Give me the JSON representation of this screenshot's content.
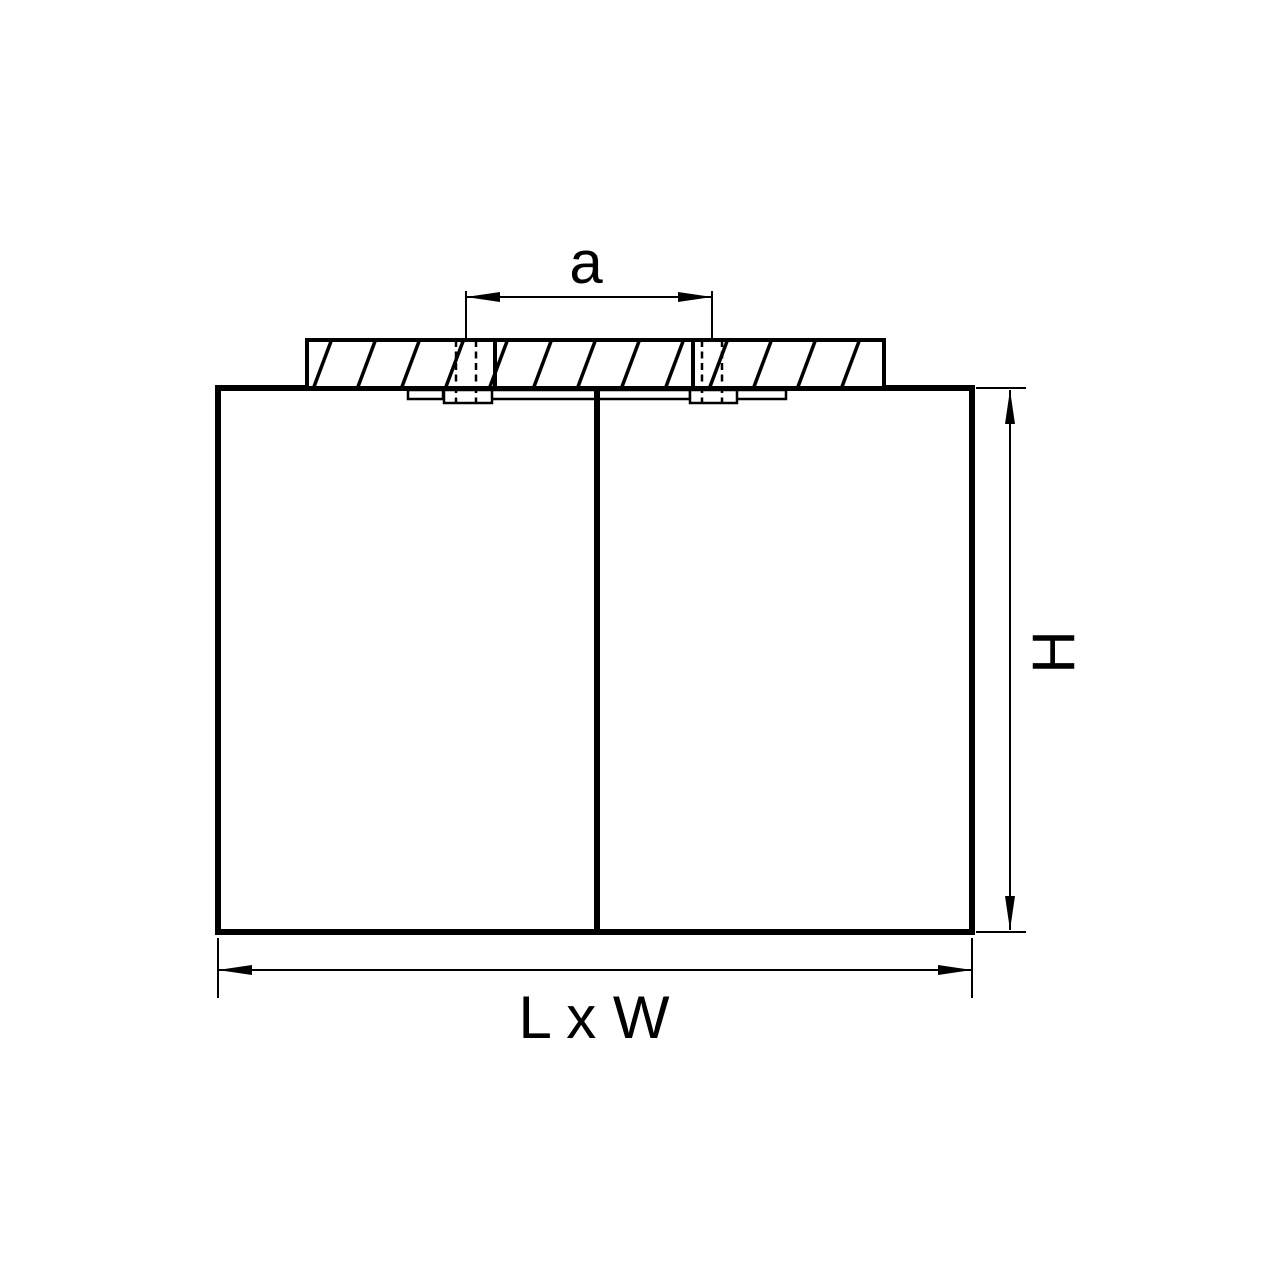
{
  "drawing": {
    "line_color": "#000000",
    "background_color": "#ffffff",
    "labels": {
      "mounting_distance": "a",
      "height": "H",
      "length_width": "L x W"
    }
  }
}
